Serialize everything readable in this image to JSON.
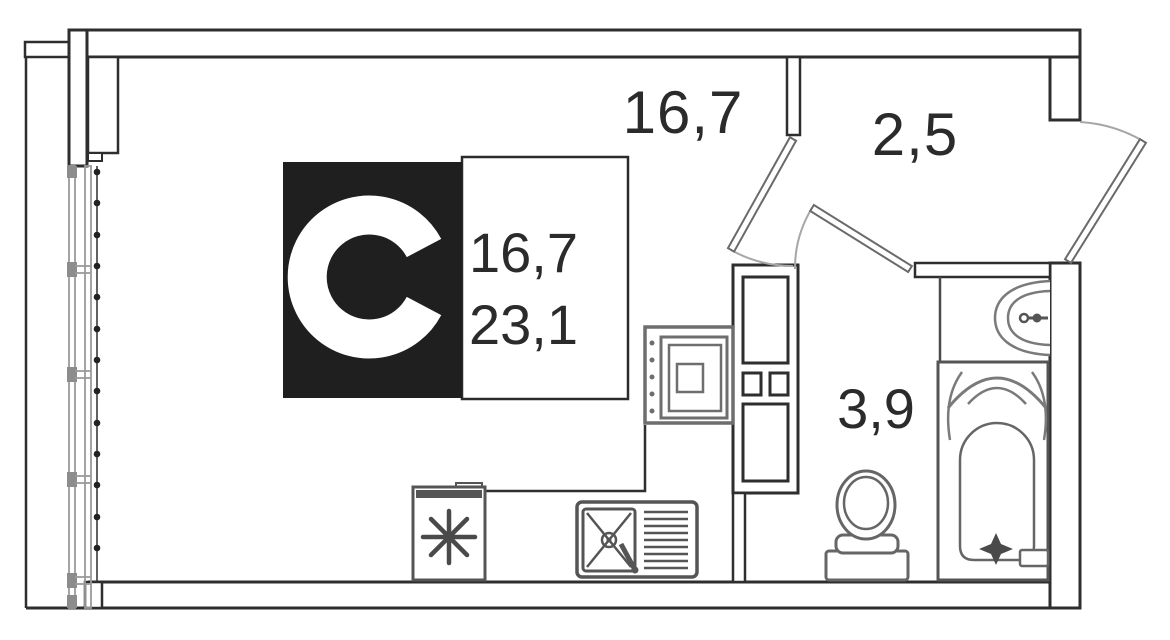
{
  "logo": {
    "letter": "C",
    "living_area": "16,7",
    "total_area": "23,1"
  },
  "rooms": {
    "living": {
      "area_label": "16,7"
    },
    "hallway": {
      "area_label": "2,5"
    },
    "bathroom": {
      "area_label": "3,9"
    }
  },
  "colors": {
    "wall": "#2e2e2e",
    "fixture_dark": "#555555",
    "fixture_mid": "#6e6e6e",
    "fixture_light": "#7a7a7a",
    "window": "#9a9a9a",
    "window_block": "#8c8c8c",
    "door": "#a6a6a6",
    "logo_bg": "#1f1f1f",
    "text": "#2b2b2b",
    "background": "#ffffff"
  },
  "fixtures": {
    "refrigerator": "snowflake-asterisk",
    "kitchen_sink": "bowl-with-cross-and-drainboard",
    "washing_machine": "top-view-square",
    "ventilation_shaft": "duct-boxes",
    "toilet": "tank-and-bowl",
    "bathtub": "tub-with-tap-star",
    "bathroom_sink": "wall-mounted-half-oval",
    "entrance_door": "swing-out-top-right",
    "room_door": "swing-into-living-room",
    "bathroom_door": "swing-into-hallway",
    "window_wall": "glazed-left-facade-with-dotted-boundary"
  }
}
